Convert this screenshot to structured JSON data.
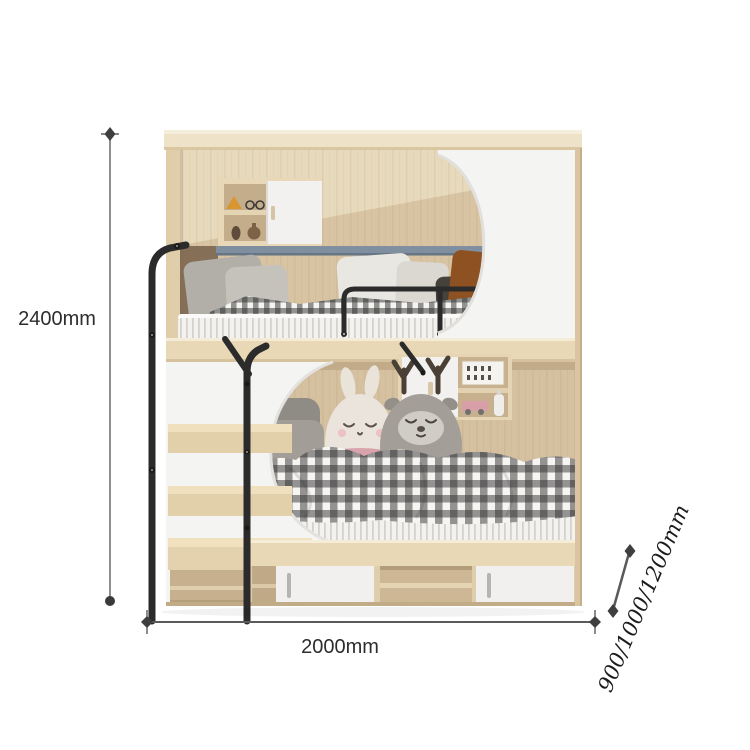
{
  "figure": {
    "kind": "product-dimension-diagram",
    "subject": "bunk bed with storage staircase"
  },
  "dimensions": {
    "height": "2400mm",
    "width": "2000mm",
    "depth": "900/1000/1200mm"
  },
  "colors": {
    "wood_light": "#eee2c8",
    "wood_frame": "#e9d8b6",
    "wood_interior": "#d7c3a2",
    "panel_white": "#f4f4f2",
    "metal_black": "#2b2b2b",
    "accent_blue_gray": "#7f8fa0",
    "dimension_line": "#6a6a6a",
    "dimension_text": "#2d2d2d"
  }
}
